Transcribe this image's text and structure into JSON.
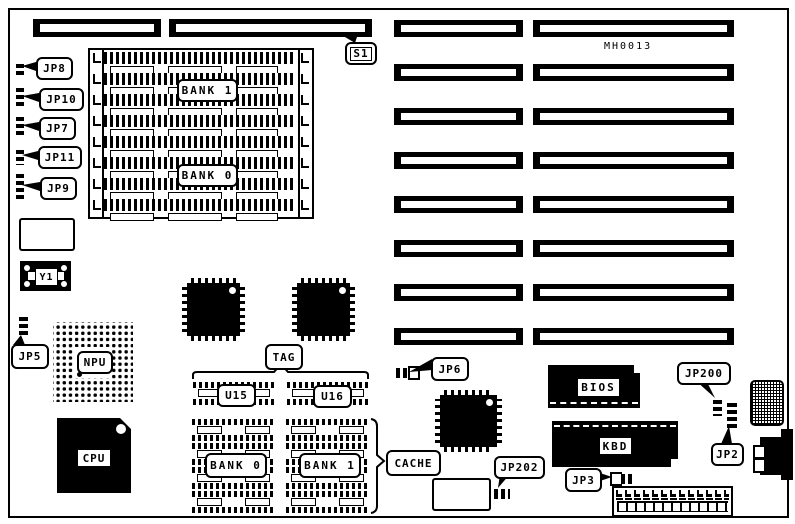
{
  "diagram": {
    "part_number": "MH0013"
  },
  "switch": {
    "s1": "S1"
  },
  "memory": {
    "bank1": "BANK 1",
    "bank0": "BANK 0"
  },
  "jumpers": {
    "jp8": "JP8",
    "jp10": "JP10",
    "jp7": "JP7",
    "jp11": "JP11",
    "jp9": "JP9",
    "jp5": "JP5",
    "jp6": "JP6",
    "jp200": "JP200",
    "jp2": "JP2",
    "jp202": "JP202",
    "jp3": "JP3"
  },
  "components": {
    "y1": "Y1",
    "npu": "NPU",
    "cpu": "CPU",
    "bios": "BIOS",
    "kbd": "KBD"
  },
  "cache": {
    "tag": "TAG",
    "u15": "U15",
    "u16": "U16",
    "bank0": "BANK 0",
    "bank1": "BANK 1",
    "label": "CACHE"
  }
}
